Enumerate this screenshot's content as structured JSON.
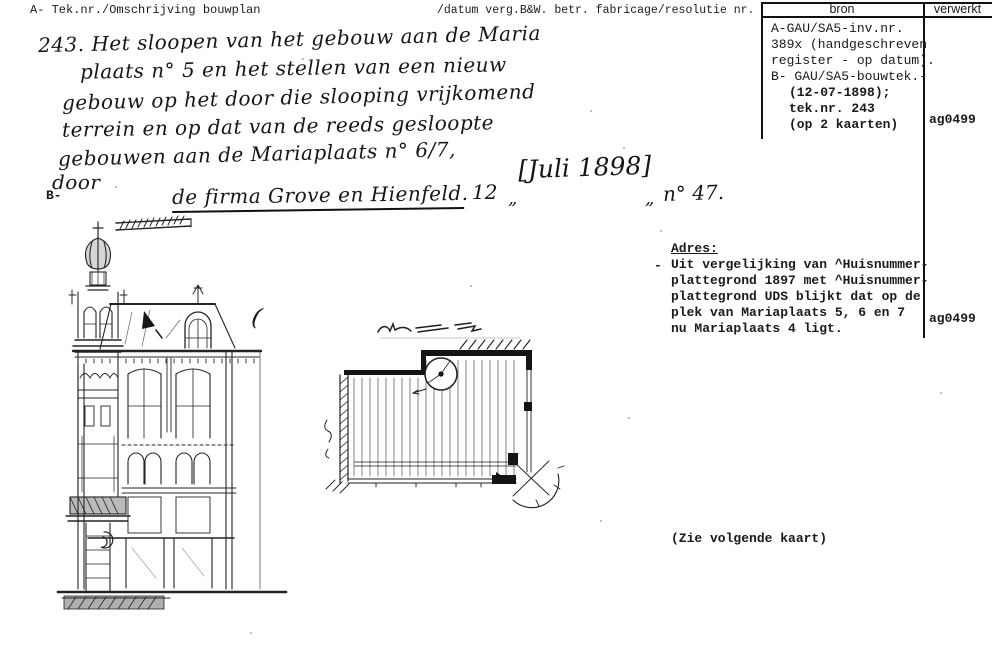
{
  "colors": {
    "ink": "#1a1a1a",
    "paper": "#ffffff"
  },
  "header": {
    "left": "A- Tek.nr./Omschrijving bouwplan",
    "mid": "/datum verg.B&W. betr. fabricage/resolutie nr.",
    "bron": "bron",
    "verwerkt": "verwerkt"
  },
  "handwriting": {
    "lines": [
      "243. Het sloopen van het gebouw aan de Maria",
      "plaats n° 5 en het stellen van een nieuw",
      "gebouw op het door die slooping vrijkomend",
      "terrein en op dat van de reeds gesloopte",
      "gebouwen aan de Mariaplaats n° 6/7,",
      "door"
    ],
    "firm": "de firma Grove en Hienfeld.",
    "day": "12",
    "ditto_left": "„",
    "date_inserted": "[Juli 1898]",
    "ditto_right": "„",
    "number": "n° 47.",
    "b_marker": "B-",
    "stray_mark": "("
  },
  "bron_cell": {
    "lines": [
      "A-GAU/SA5-inv.nr.",
      "389x (handgeschreven",
      "register - op datum).",
      "B- GAU/SA5-bouwtek.-"
    ],
    "bold_lines": [
      "(12-07-1898);",
      "tek.nr. 243",
      "(op 2 kaarten)"
    ]
  },
  "verwerkt_cell": {
    "top": "ag0499",
    "bottom": "ag0499"
  },
  "adres": {
    "dash": "-",
    "title": "Adres:",
    "lines": [
      "Uit vergelijking van ^Huisnummer-",
      "plattegrond 1897 met ^Huisnummer-",
      "plattegrond UDS blijkt dat op de",
      "plek van Mariaplaats 5, 6 en 7",
      "nu Mariaplaats 4 ligt."
    ]
  },
  "note": "(Zie volgende kaart)"
}
